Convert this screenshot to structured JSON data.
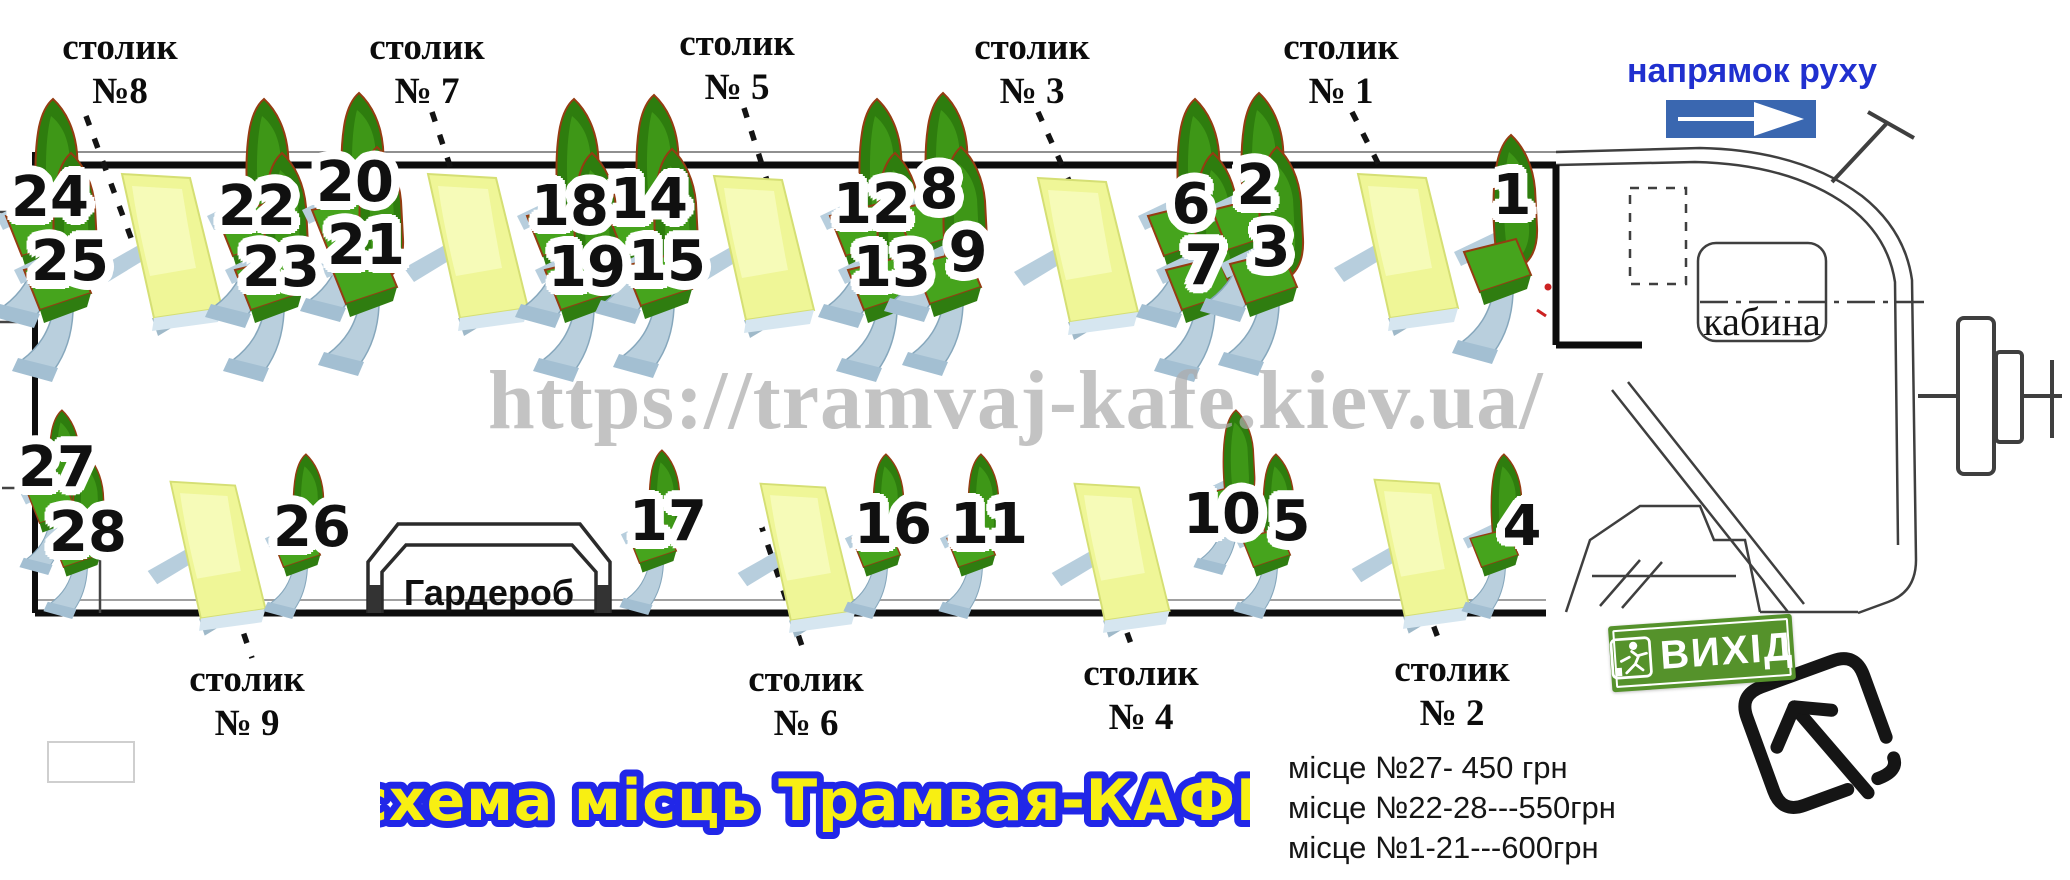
{
  "title": "схема місць Трамвая-КАФЕ",
  "direction_label": "напрямок руху",
  "watermark": "https://tramvaj-kafe.kiev.ua/",
  "cabin_label": "кабина",
  "wardrobe_label": "Гардероб",
  "exit_label": "ВИХІД",
  "prices": {
    "line1": "місце №27- 450 грн",
    "line2": "місце №22-28---550грн",
    "line3": "місце №1-21---600грн"
  },
  "table_labels": {
    "t8": {
      "line1": "столик",
      "line2": "№8"
    },
    "t7": {
      "line1": "столик",
      "line2": "№ 7"
    },
    "t5": {
      "line1": "столик",
      "line2": "№ 5"
    },
    "t3": {
      "line1": "столик",
      "line2": "№ 3"
    },
    "t1": {
      "line1": "столик",
      "line2": "№ 1"
    },
    "t9": {
      "line1": "столик",
      "line2": "№ 9"
    },
    "t6": {
      "line1": "столик",
      "line2": "№ 6"
    },
    "t4": {
      "line1": "столик",
      "line2": "№ 4"
    },
    "t2": {
      "line1": "столик",
      "line2": "№ 2"
    }
  },
  "seats": {
    "s1": "1",
    "s2": "2",
    "s3": "3",
    "s4": "4",
    "s5": "5",
    "s6": "6",
    "s7": "7",
    "s8": "8",
    "s9": "9",
    "s10": "10",
    "s11": "11",
    "s12": "12",
    "s13": "13",
    "s14": "14",
    "s15": "15",
    "s16": "16",
    "s17": "17",
    "s18": "18",
    "s19": "19",
    "s20": "20",
    "s21": "21",
    "s22": "22",
    "s23": "23",
    "s24": "24",
    "s25": "25",
    "s26": "26",
    "s27": "27",
    "s28": "28"
  },
  "colors": {
    "seat_back": "#2e7d0e",
    "seat_cushion": "#46a41d",
    "table_top": "#eff697",
    "accent_blue": "#2030cf",
    "arrow_box_blue": "#3a67b0",
    "exit_green": "#55922b",
    "title_fill": "#f8ef12",
    "title_stroke": "#2127e8",
    "watermark_gray": "#adadad"
  }
}
